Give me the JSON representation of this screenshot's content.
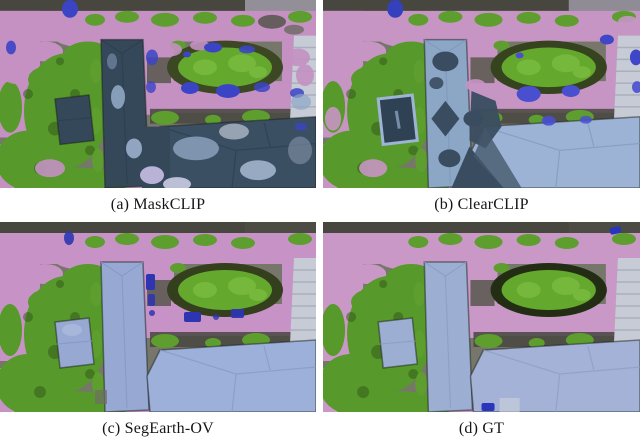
{
  "figure": {
    "panels": [
      {
        "key": "a",
        "caption": "(a) MaskCLIP"
      },
      {
        "key": "b",
        "caption": "(b) ClearCLIP"
      },
      {
        "key": "c",
        "caption": "(c) SegEarth-OV"
      },
      {
        "key": "d",
        "caption": "(d) GT"
      }
    ],
    "palette": {
      "road_pink": "#c795c4",
      "vegetation_green": "#57992a",
      "field_green": "#65a82e",
      "building_dark_slate": "#35485a",
      "building_light_blue": "#98aad4",
      "vehicle_blue": "#3039b6",
      "page_background": "#ffffff",
      "caption_color": "#161616"
    }
  }
}
